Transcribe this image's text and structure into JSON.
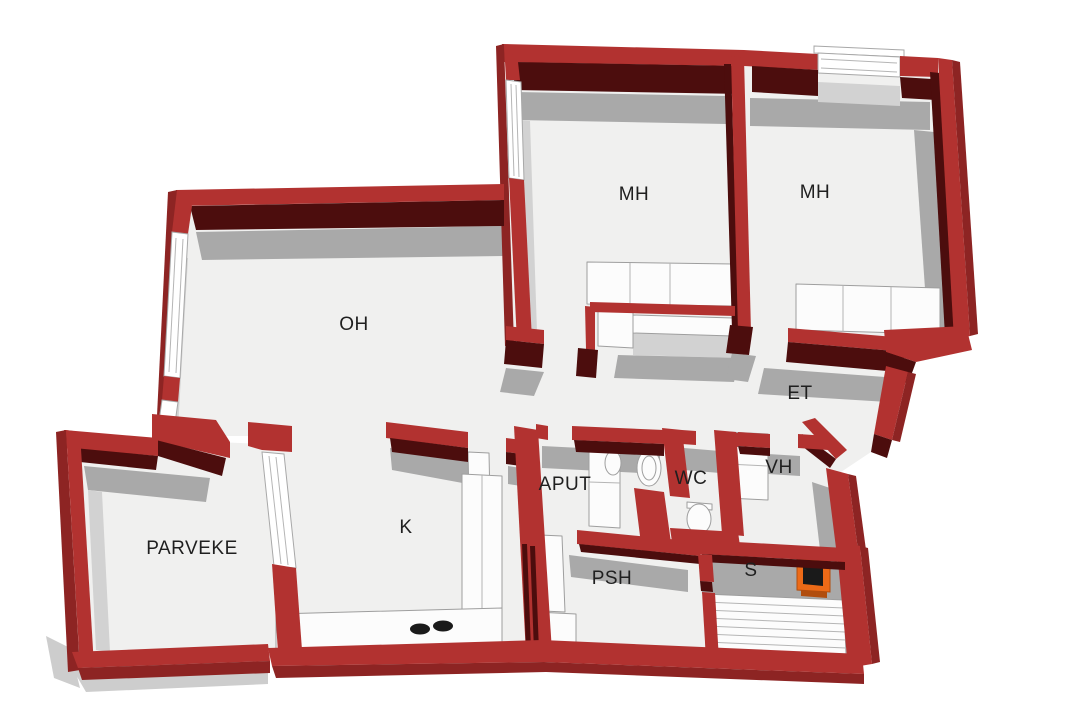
{
  "plan": {
    "type": "apartment-floor-plan-3d",
    "rooms": [
      {
        "key": "bedroom-left",
        "label": "MH"
      },
      {
        "key": "bedroom-right",
        "label": "MH"
      },
      {
        "key": "living-room",
        "label": "OH"
      },
      {
        "key": "entry-hall",
        "label": "ET"
      },
      {
        "key": "utility-room",
        "label": "APUT"
      },
      {
        "key": "toilet-room",
        "label": "WC"
      },
      {
        "key": "wardrobe-room",
        "label": "VH"
      },
      {
        "key": "kitchen",
        "label": "K"
      },
      {
        "key": "balcony",
        "label": "PARVEKE"
      },
      {
        "key": "shower-room",
        "label": "PSH"
      },
      {
        "key": "sauna",
        "label": "S"
      }
    ]
  },
  "colors": {
    "background": "#ffffff",
    "wall_top": "#b23230",
    "wall_side": "#8d2423",
    "wall_dark": "#4c0d0d",
    "floor": "#f0f0ef",
    "shadow": "#a9a9a9",
    "shadow_soft": "#cdcdcd",
    "furniture": "#fcfcfc",
    "furniture_stroke": "#9e9e9e",
    "sauna_stove": "#ed6a17",
    "sauna_stove_dark": "#b14d0e",
    "appliance_black": "#1a1a1a",
    "label": "#1f1f1f"
  }
}
